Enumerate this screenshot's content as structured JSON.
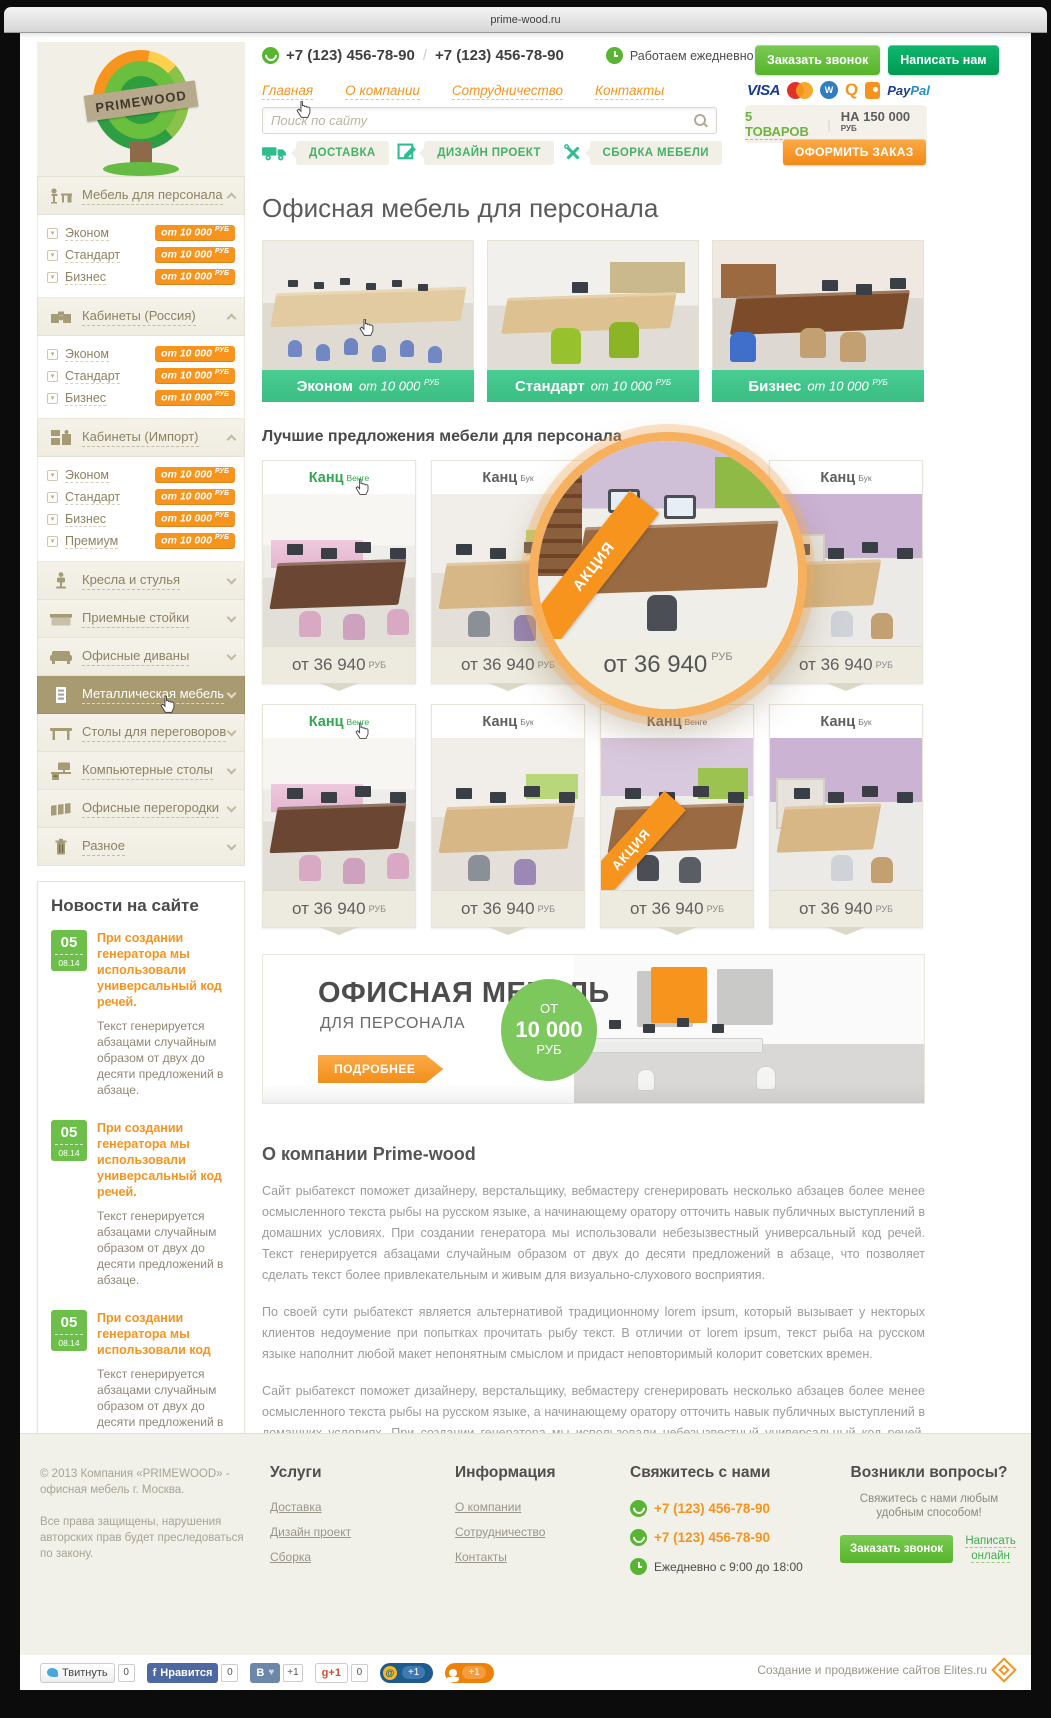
{
  "browser": {
    "url": "prime-wood.ru"
  },
  "theme": {
    "orange": "#f7941e",
    "green": "#66bb44",
    "emerald": "#00a651",
    "mint": "#3ec08b",
    "sidebar_active": "#a89b72"
  },
  "header": {
    "logo": "PRIMEWOOD",
    "phone1": "+7 (123) 456-78-90",
    "phone2": "+7 (123) 456-78-90",
    "hours": "Работаем ежедневно с 9:00 до 18:00",
    "callback": "Заказать звонок",
    "write_us": "Написать нам",
    "nav": [
      "Главная",
      "О компании",
      "Сотрудничество",
      "Контакты"
    ],
    "search_placeholder": "Поиск по сайту",
    "payments": {
      "visa": "VISA",
      "qiwi": "Q",
      "webmoney": "W",
      "paypal_dark": "Pay",
      "paypal_light": "Pal"
    },
    "cart_count": "5 ТОВАРОВ",
    "cart_total": "НА 150 000",
    "cart_currency": "РУБ",
    "checkout": "ОФОРМИТЬ ЗАКАЗ",
    "services": [
      "ДОСТАВКА",
      "ДИЗАЙН ПРОЕКТ",
      "СБОРКА МЕБЕЛИ"
    ]
  },
  "sidebar": {
    "categories": [
      {
        "label": "Мебель для персонала",
        "items": [
          {
            "label": "Эконом",
            "price": "от 10 000",
            "currency": "РУБ"
          },
          {
            "label": "Стандарт",
            "price": "от 10 000",
            "currency": "РУБ"
          },
          {
            "label": "Бизнес",
            "price": "от 10 000",
            "currency": "РУБ"
          }
        ]
      },
      {
        "label": "Кабинеты (Россия)",
        "items": [
          {
            "label": "Эконом",
            "price": "от 10 000",
            "currency": "РУБ"
          },
          {
            "label": "Стандарт",
            "price": "от 10 000",
            "currency": "РУБ"
          },
          {
            "label": "Бизнес",
            "price": "от 10 000",
            "currency": "РУБ"
          }
        ]
      },
      {
        "label": "Кабинеты (Импорт)",
        "items": [
          {
            "label": "Эконом",
            "price": "от 10 000",
            "currency": "РУБ"
          },
          {
            "label": "Стандарт",
            "price": "от 10 000",
            "currency": "РУБ"
          },
          {
            "label": "Бизнес",
            "price": "от 10 000",
            "currency": "РУБ"
          },
          {
            "label": "Премиум",
            "price": "от 10 000",
            "currency": "РУБ"
          }
        ]
      },
      {
        "label": "Кресла и стулья"
      },
      {
        "label": "Приемные стойки"
      },
      {
        "label": "Офисные диваны"
      },
      {
        "label": "Металлическая мебель"
      },
      {
        "label": "Столы для переговоров"
      },
      {
        "label": "Компьютерные столы"
      },
      {
        "label": "Офисные перегородки"
      },
      {
        "label": "Разное"
      }
    ]
  },
  "news": {
    "title": "Новости на сайте",
    "all_button": "ВСЕ НОВОСТИ",
    "items": [
      {
        "day": "05",
        "date": "08.14",
        "title": "При создании генератора мы использовали универсальный код речей.",
        "text": "Текст генерируется абзацами случайным образом от двух до десяти предложений в абзаце."
      },
      {
        "day": "05",
        "date": "08.14",
        "title": "При создании генератора мы использовали универсальный код речей.",
        "text": "Текст генерируется абзацами случайным образом от двух до десяти предложений в абзаце."
      },
      {
        "day": "05",
        "date": "08.14",
        "title": "При создании генератора мы использовали код",
        "text": "Текст генерируется абзацами случайным образом от двух до десяти предложений в абзаце."
      }
    ]
  },
  "main": {
    "page_title": "Офисная мебель для персонала",
    "categories": [
      {
        "name": "Эконом",
        "price": "от 10 000",
        "currency": "РУБ"
      },
      {
        "name": "Стандарт",
        "price": "от 10 000",
        "currency": "РУБ"
      },
      {
        "name": "Бизнес",
        "price": "от 10 000",
        "currency": "РУБ"
      }
    ],
    "offers_title": "Лучшие предложения мебели для персонала",
    "products": [
      {
        "name": "Канц",
        "variant": "Венге",
        "price": "от 36 940",
        "currency": "РУБ"
      },
      {
        "name": "Канц",
        "variant": "Бук",
        "price": "от 36 940",
        "currency": "РУБ"
      },
      {
        "name": "Канц",
        "variant": "Бук",
        "price": "от 36 940",
        "currency": "РУБ",
        "badge": "АКЦИЯ"
      },
      {
        "name": "Канц",
        "variant": "Бук",
        "price": "от 36 940",
        "currency": "РУБ"
      },
      {
        "name": "Канц",
        "variant": "Венге",
        "price": "от 36 940",
        "currency": "РУБ"
      },
      {
        "name": "Канц",
        "variant": "Бук",
        "price": "от 36 940",
        "currency": "РУБ"
      },
      {
        "name": "Канц",
        "variant": "Венге",
        "price": "от 36 940",
        "currency": "РУБ",
        "badge": "АКЦИЯ"
      },
      {
        "name": "Канц",
        "variant": "Бук",
        "price": "от 36 940",
        "currency": "РУБ"
      }
    ],
    "banner": {
      "title": "ОФИСНАЯ МЕБЕЛЬ",
      "subtitle": "ДЛЯ ПЕРСОНАЛА",
      "circle_from": "ОТ",
      "circle_price": "10 000",
      "circle_currency": "РУБ",
      "button": "ПОДРОБНЕЕ"
    },
    "about_title": "О компании Prime-wood",
    "about_paragraphs": [
      "Сайт рыбатекст поможет дизайнеру, верстальщику, вебмастеру сгенерировать несколько абзацев более менее осмысленного текста рыбы на русском языке, а начинающему оратору отточить навык публичных выступлений в домашних условиях. При создании генератора мы использовали небезызвестный универсальный код речей. Текст генерируется абзацами случайным образом от двух до десяти предложений в абзаце, что позволяет сделать текст более привлекательным и живым для визуально-слухового восприятия.",
      "По своей сути рыбатекст является альтернативой традиционному lorem ipsum, который вызывает у некторых клиентов недоумение при попытках прочитать рыбу текст. В отличии от lorem ipsum, текст рыба на русском языке наполнит любой макет непонятным смыслом и придаст неповторимый колорит советских времен.",
      "Сайт рыбатекст поможет дизайнеру, верстальщику, вебмастеру сгенерировать несколько абзацев более менее осмысленного текста рыбы на русском языке, а начинающему оратору отточить навык публичных выступлений в домашних условиях. При создании генератора мы использовали небезызвестный универсальный код речей. Текст генерируется абзацами случайным образом от двух до десяти предложений в абзаце, что позволяет сделать текст более привлекательным и живым для визуально-слухового восприятия."
    ]
  },
  "footer": {
    "copyright1": "© 2013 Компания «PRIMEWOOD» - офисная мебель г. Москва.",
    "copyright2": "Все права защищены, нарушения авторских прав будет преследоваться по закону.",
    "services_title": "Услуги",
    "services_links": [
      "Доставка",
      "Дизайн проект",
      "Сборка"
    ],
    "info_title": "Информация",
    "info_links": [
      "О компании",
      "Сотрудничество",
      "Контакты"
    ],
    "contact_title": "Свяжитесь с нами",
    "phone1": "+7 (123) 456-78-90",
    "phone2": "+7 (123) 456-78-90",
    "hours": "Ежедневно с 9:00 до 18:00",
    "questions_title": "Возникли вопросы?",
    "questions_text": "Свяжитесь с нами любым удобным способом!",
    "callback": "Заказать звонок",
    "write_online": "Написать онлайн"
  },
  "social": {
    "twitter_label": "Твитнуть",
    "twitter_count": "0",
    "fb_label": "Нравится",
    "fb_count": "0",
    "vk_label": "В",
    "vk_heart": "♥",
    "vk_count": "+1",
    "gplus_label": "g+1",
    "gplus_count": "0",
    "mail_label": "@",
    "mail_count": "+1",
    "ok_count": "+1",
    "credits": "Создание и продвижение сайтов Elites.ru"
  }
}
